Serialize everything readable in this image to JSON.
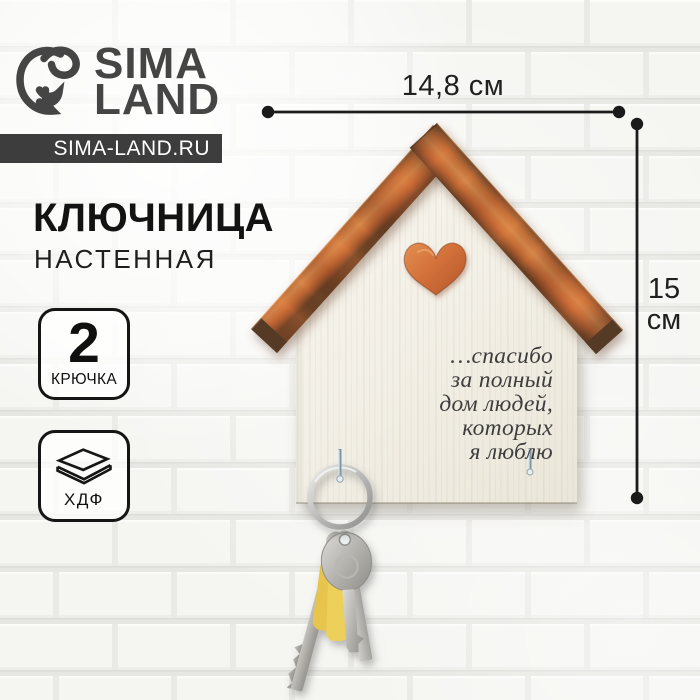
{
  "brand": {
    "name_line1": "SIMA",
    "name_line2": "LAND",
    "website": "SIMA-LAND.RU",
    "logo_icon": "sima-land-bird-icon",
    "brand_color": "#454545",
    "bar_color": "#3d3d3d"
  },
  "product": {
    "title": "КЛЮЧНИЦА",
    "subtitle": "НАСТЕННАЯ",
    "quote_lines": [
      "…спасибо",
      "за полный",
      "дом людей,",
      "которых",
      "я люблю"
    ]
  },
  "badges": {
    "hooks": {
      "value": "2",
      "label": "КРЮЧКА"
    },
    "material": {
      "label": "ХДФ",
      "icon": "layered-boards-icon"
    }
  },
  "dimensions": {
    "width": "14,8 см",
    "height_value": "15",
    "height_unit": "см"
  },
  "colors": {
    "roof": "#c9743c",
    "board": "#f3f0e7",
    "heart": "#d4713a",
    "dimension_lines": "#1c1c1c",
    "keys_metal": "#b9b7b2",
    "keys_plastic": "#e7c54e"
  }
}
